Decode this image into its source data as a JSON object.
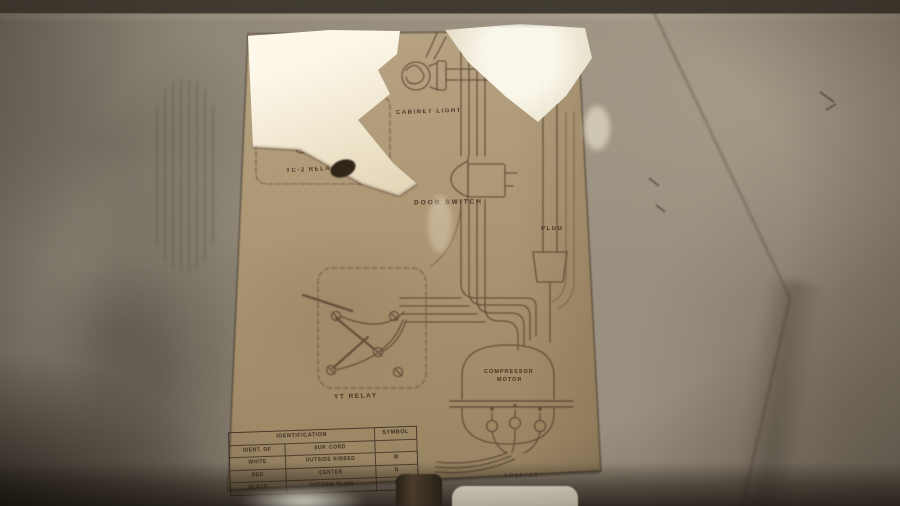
{
  "colors": {
    "metal_panel": "#92897a",
    "label_cardboard": "#a8926f",
    "printed_ink": "#4a3826",
    "torn_paper": "#f3ecd9"
  },
  "diagram": {
    "labels": {
      "yc2_relay": "YC-2 RELAY",
      "cabinet_light": "CABINET LIGHT",
      "door_switch": "DOOR SWITCH",
      "plug": "PLUG",
      "yt_relay": "YT RELAY",
      "compressor_line1": "COMPRESSOR",
      "compressor_line2": "MOTOR",
      "part_number": "5B50723"
    }
  },
  "id_table": {
    "header_identification": "IDENTIFICATION",
    "header_symbol": "SYMBOL",
    "rows": [
      {
        "c1": "IDENT. OF",
        "c2": "SUP. CORD",
        "sym": ""
      },
      {
        "c1": "WHITE",
        "c2": "OUTSIDE RIBBED",
        "sym": "W"
      },
      {
        "c1": "RED",
        "c2": "CENTER",
        "sym": "R"
      },
      {
        "c1": "BLACK",
        "c2": "OUTSIDE PLAIN",
        "sym": "B"
      }
    ]
  }
}
